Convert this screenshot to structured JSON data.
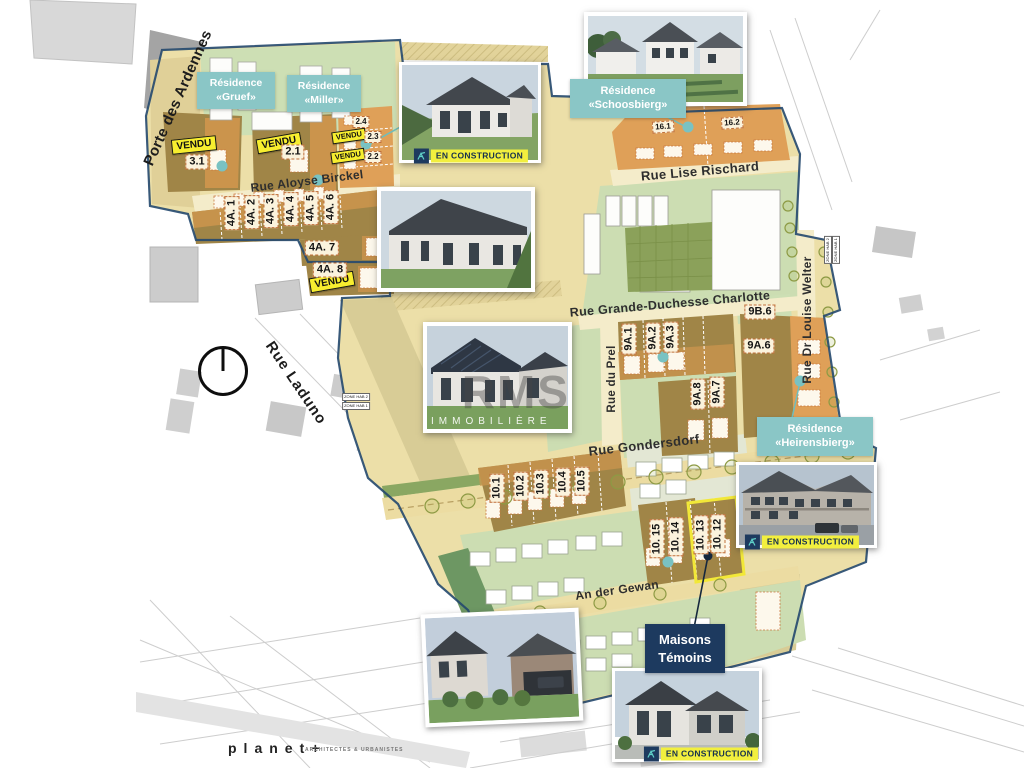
{
  "streets": {
    "porte_des_ardennes": "Porte des Ardennes",
    "rue_aloyse_birckel": "Rue Aloyse Birckel",
    "rue_lise_rischard": "Rue Lise Rischard",
    "rue_grande_duchesse_charlotte": "Rue Grande-Duchesse Charlotte",
    "rue_laduno": "Rue Laduno",
    "rue_du_prel": "Rue du Prel",
    "rue_dr_louise_welter": "Rue Dr Louise Welter",
    "rue_gondersdorf": "Rue Gondersdorf",
    "an_der_gewan": "An der Gewan"
  },
  "residences": {
    "gruef": {
      "line1": "Résidence",
      "line2": "«Gruef»"
    },
    "miller": {
      "line1": "Résidence",
      "line2": "«Miller»"
    },
    "schoosbierg": {
      "line1": "Résidence",
      "line2": "«Schoosbierg»"
    },
    "heirensbierg": {
      "line1": "Résidence",
      "line2": "«Heirensbierg»"
    }
  },
  "badges": {
    "vendu": "VENDU",
    "en_construction": "EN CONSTRUCTION"
  },
  "maisons_temoins": {
    "line1": "Maisons",
    "line2": "Témoins"
  },
  "lots": {
    "l3_1": "3.1",
    "l2_1": "2.1",
    "l2_2": "2.2",
    "l2_3": "2.3",
    "l2_4": "2.4",
    "l4a_1": "4A. 1",
    "l4a_2": "4A. 2",
    "l4a_3": "4A. 3",
    "l4a_4": "4A. 4",
    "l4a_5": "4A. 5",
    "l4a_6": "4A. 6",
    "l4a_7": "4A. 7",
    "l4a_8": "4A. 8",
    "l16_1": "16.1",
    "l16_2": "16.2",
    "l9b_6": "9B.6",
    "l9a_1": "9A.1",
    "l9a_2": "9A.2",
    "l9a_3": "9A.3",
    "l9a_6": "9A.6",
    "l9a_7": "9A.7",
    "l9a_8": "9A.8",
    "l10_1": "10.1",
    "l10_2": "10.2",
    "l10_3": "10.3",
    "l10_4": "10.4",
    "l10_5": "10.5",
    "l10_12": "10. 12",
    "l10_13": "10. 13",
    "l10_14": "10. 14",
    "l10_15": "10. 15"
  },
  "zone_tags": {
    "t1": "ZONE HAB 2",
    "t2": "ZONE HAB 1"
  },
  "watermark": {
    "big": "RMS",
    "sub": "IMMOBILIÈRE"
  },
  "footer": {
    "brand": "planet+",
    "tagline": "ARCHITECTES & URBANISTES"
  },
  "colors": {
    "teal": "#8ac6c6",
    "yellow": "#f7ee2f",
    "navy": "#1d3a5f",
    "brown": "#a08547",
    "orange": "#dfa058",
    "green": "#ccddb2",
    "cream": "#ecdfa8"
  }
}
